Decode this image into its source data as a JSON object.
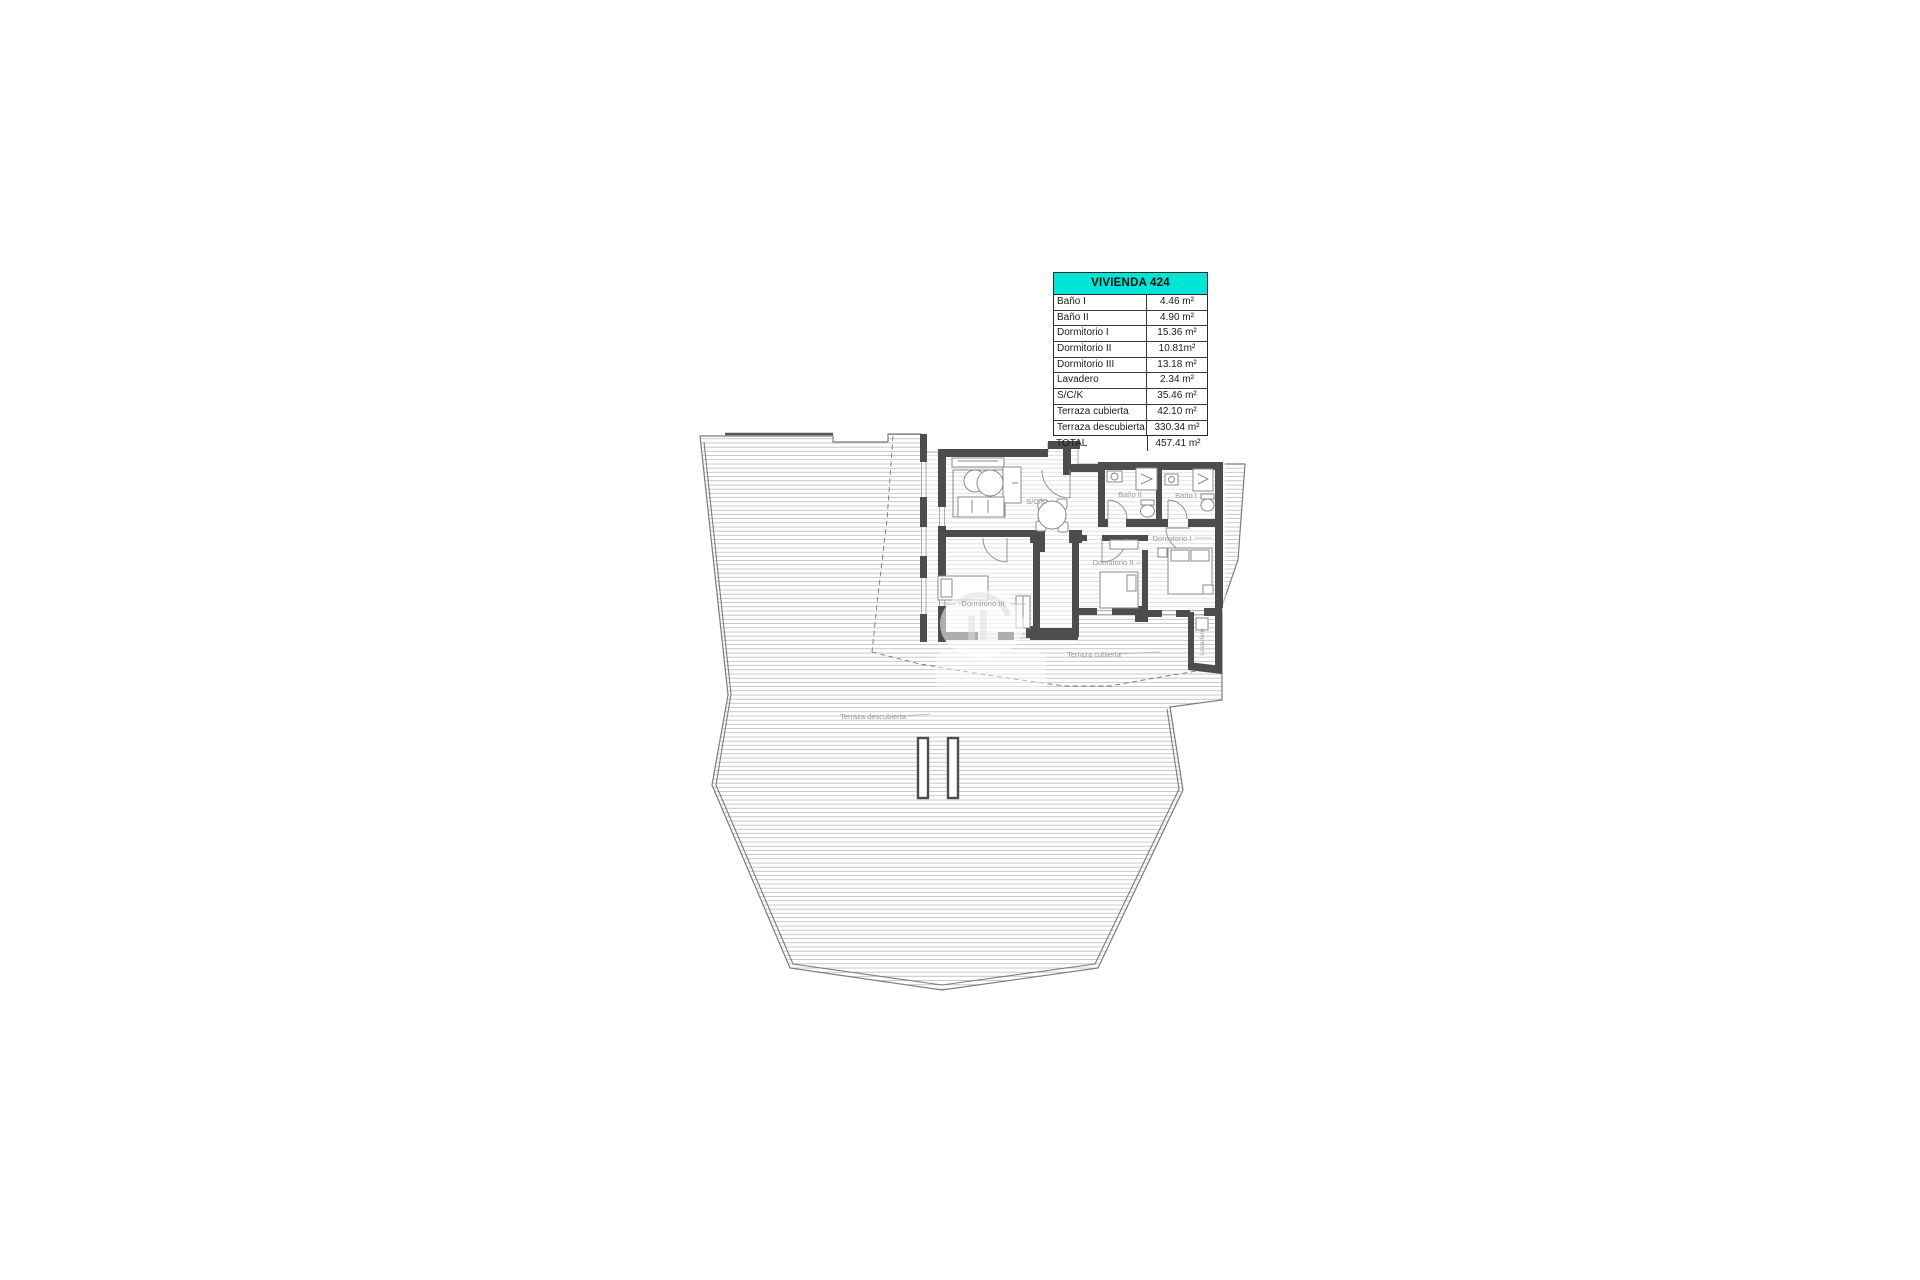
{
  "legend_table": {
    "title": "VIVIENDA 424",
    "header_color": "#00e5d6",
    "rows": [
      {
        "label": "Baño I",
        "value": "4.46 m²"
      },
      {
        "label": "Baño II",
        "value": "4.90 m²"
      },
      {
        "label": "Dormitorio I",
        "value": "15.36 m²"
      },
      {
        "label": "Dormitorio II",
        "value": "10.81m²"
      },
      {
        "label": "Dormitorio III",
        "value": "13.18 m²"
      },
      {
        "label": "Lavadero",
        "value": "2.34 m²"
      },
      {
        "label": "S/C/K",
        "value": "35.46 m²"
      },
      {
        "label": "Terraza cubierta",
        "value": "42.10 m²"
      },
      {
        "label": "Terraza descubierta",
        "value": "330.34 m²"
      }
    ],
    "total": {
      "label": "TOTAL",
      "value": "457.41 m²"
    }
  },
  "plan": {
    "labels": {
      "sck": "S/C/K",
      "bano1": "Baño I",
      "bano2": "Baño II",
      "dorm1": "Dormitorio I",
      "dorm2": "Dormitorio II",
      "dorm3": "Dormitorio III",
      "lavadero": "Lavadero",
      "terraza_cubierta": "Terraza cubierta",
      "terraza_descubierta": "Terraza descubierta"
    },
    "wall_color": "#4d4d4d",
    "hatch_color": "#b2b2b2",
    "label_color": "#9a9a9a"
  }
}
